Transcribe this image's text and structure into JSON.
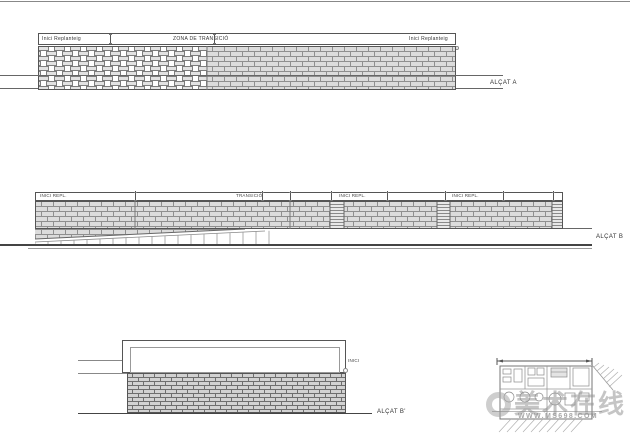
{
  "sheet_title": "Brick wall elevations drawing",
  "alcat_a": {
    "header_left": "Inici Replanteig",
    "header_center": "ZONA DE TRANSICIÓ",
    "header_right": "Inici Replanteig",
    "label": "ALÇAT A"
  },
  "alcat_b": {
    "seg1_label": "INICI REPL.",
    "seg2_label": "TRANSICIÓ",
    "seg3_label": "INICI REPL.",
    "seg4_label": "INICI REPL.",
    "label": "ALÇAT B"
  },
  "alcat_b_prime": {
    "note": "INICI",
    "label": "ALÇAT B'"
  },
  "watermark": {
    "cn_text": "美术在线",
    "url_text": "WWW.MS698.COM"
  },
  "colors": {
    "line": "#555555",
    "brick_fill": "#dcdcdc",
    "brick_joint": "#8f8f8f",
    "watermark_gray": "#969696"
  }
}
